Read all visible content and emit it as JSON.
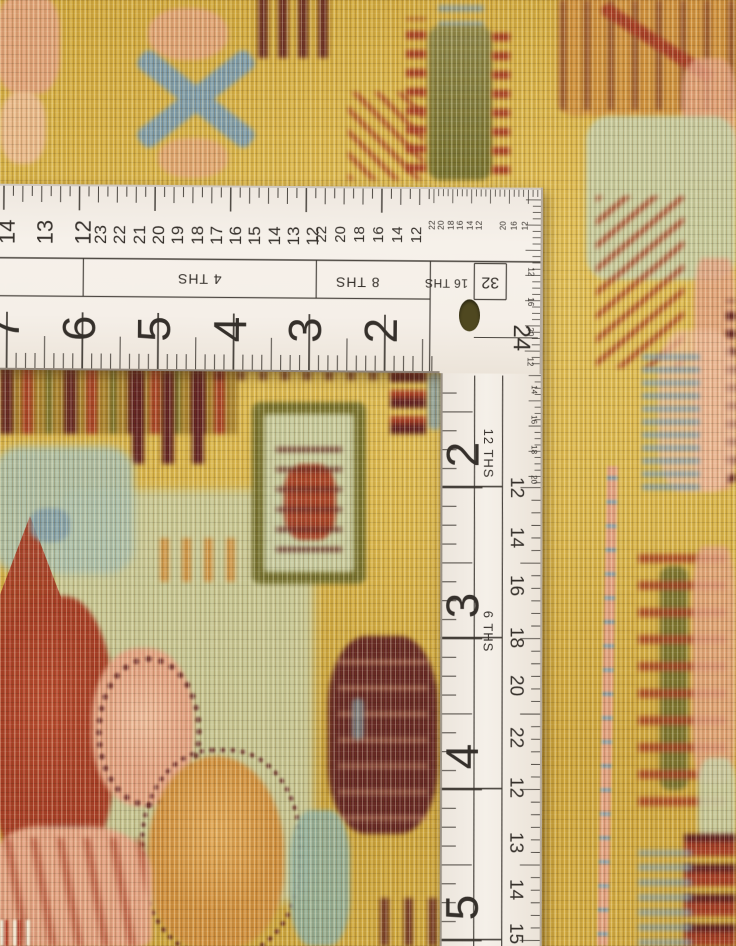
{
  "ruler": {
    "horizontal": {
      "top_scale_numbers": {
        "halves": [
          "14",
          "13",
          "12"
        ],
        "quarters": [
          "23",
          "22",
          "21",
          "20",
          "19",
          "18",
          "17",
          "16",
          "15",
          "14",
          "13",
          "12"
        ],
        "eighths": [
          "22",
          "20",
          "18",
          "16",
          "14",
          "12"
        ],
        "sixteenths": [
          "22",
          "20",
          "18",
          "16",
          "14",
          "12"
        ],
        "thirtyseconds": [
          "20",
          "16",
          "12"
        ]
      },
      "inch_numbers": [
        "7",
        "6",
        "5",
        "4",
        "3",
        "2"
      ],
      "band_labels": {
        "ths4": "4 THS",
        "ths8": "8 THS",
        "ths16": "16 THS",
        "box": "32"
      }
    },
    "corner": {
      "scale_label": "24",
      "edge_numbers": [
        "12",
        "16",
        "20",
        "12"
      ]
    },
    "vertical": {
      "inch_numbers": [
        "2",
        "3",
        "4",
        "5"
      ],
      "band_labels": {
        "ths12": "12 THS",
        "ths6": "6 THS"
      },
      "column_numbers": [
        "12",
        "14",
        "16",
        "18",
        "20",
        "22",
        "12",
        "13",
        "14",
        "15"
      ],
      "edge_numbers": [
        "14",
        "16",
        "18",
        "20"
      ]
    },
    "colors": {
      "body": "#f4efe8",
      "ink": "#35302b",
      "tick": "#3a352f",
      "hole": "#4f4820"
    }
  },
  "rug": {
    "palette": {
      "gold": "#d4ac41",
      "gold_light": "#e6ca6e",
      "gold_dark": "#a8822f",
      "sage": "#c5cba3",
      "sage_blue": "#a9bfae",
      "blue": "#7e9cab",
      "teal": "#8fae9e",
      "brick": "#a63c26",
      "maroon": "#5f2023",
      "salmon": "#e2a183",
      "salmon_light": "#edbb9d",
      "orange": "#cf8f3f",
      "olive": "#716e2d"
    }
  }
}
